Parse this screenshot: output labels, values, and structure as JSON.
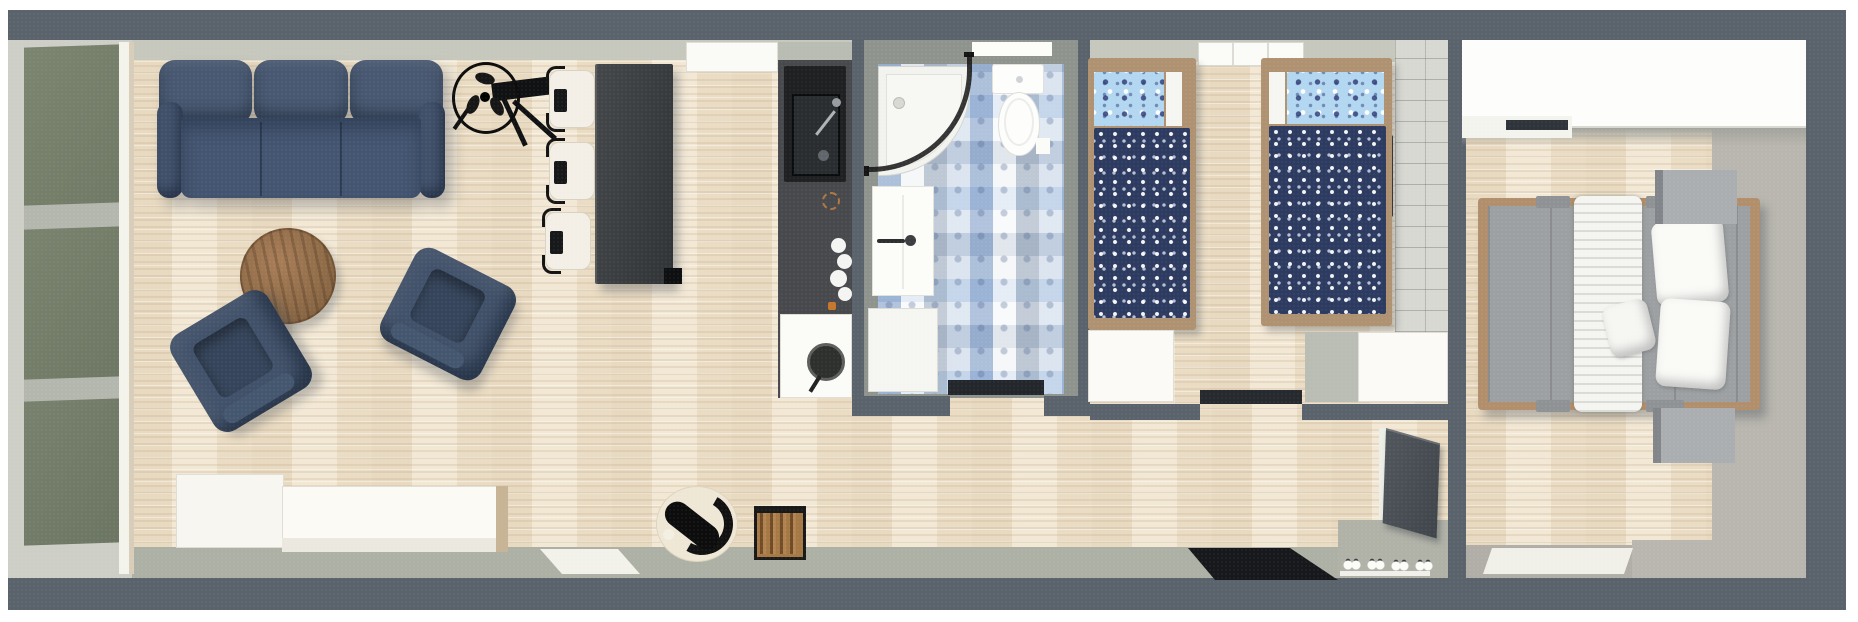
{
  "scene": {
    "kind": "3d floor plan, top-down view",
    "layout": "long narrow single-story home; living room and kitchen on left, bathroom and kids bedroom center, master bedroom right, hallway along bottom",
    "no_visible_text": true
  },
  "palette": {
    "outer_wall": "#5a626b",
    "inner_wall_top_face": "#c6c8be",
    "inner_wall_bottom_face": "#adb0a5",
    "wood_floor": "#efe2ca",
    "glass_door_green": "#77816d",
    "sofa_upholstery_blue": "#42526a",
    "coffee_table_wood": "#97714e",
    "counter_charcoal": "#47494c",
    "sink_black": "#1e2022",
    "bathroom_wall_gray": "#8f938e",
    "bathroom_tile_blue": "#a9c4e0",
    "kids_duvet_navy": "#2d3b60",
    "kids_pillow_blue": "#b3d7f0",
    "bed_frame_wood_tan": "#ae9272",
    "master_duvet_gray": "#9da0a2",
    "rug_gray": "#b8b6ae",
    "cabinet_white": "#f7f6f1",
    "doormat_black": "#17181b",
    "crate_wood": "#a57946"
  },
  "rooms": [
    {
      "name": "living-room",
      "position": "left",
      "floor": "light wood planks",
      "glazing": "full-height green glass doors on left end wall",
      "furniture": [
        "three-seat-sofa",
        "pedestal-fan",
        "black-side-table",
        "round-coffee-table",
        "armchair-left",
        "armchair-right",
        "white-sideboard",
        "bar-table",
        "bar-stool-1",
        "bar-stool-2",
        "bar-stool-3",
        "pet-bed",
        "firewood-crate",
        "white-floor-mat"
      ]
    },
    {
      "name": "kitchen",
      "position": "center-left along top wall",
      "furniture": [
        "white-upper-counter",
        "charcoal-counter",
        "black-sink-with-faucet",
        "gas-burner-ring",
        "hob-knobs",
        "oven-cabinet",
        "frying-pan"
      ]
    },
    {
      "name": "bathroom",
      "position": "center top",
      "floor": "blue-white patchwork tiles",
      "furniture": [
        "corner-shower-curved-glass",
        "toilet",
        "wall-shelf",
        "vanity-sink",
        "washer-cabinet",
        "dark-doormat"
      ]
    },
    {
      "name": "kids-bedroom",
      "position": "center-right",
      "floor": "light wood planks",
      "wall_finish": "gray tile wall on right side",
      "bedding": "navy polka-dot duvets with light-blue patterned pillows",
      "furniture": [
        "single-bed-left",
        "single-bed-right",
        "window-top-wall",
        "white-cabinet-left",
        "gray-dresser",
        "white-cabinet-right",
        "dark-doormat",
        "wall-handle"
      ]
    },
    {
      "name": "hallway",
      "position": "bottom strip",
      "furniture": [
        "entry-door-open",
        "black-doormat",
        "shoe-mat",
        "shoe-pairs"
      ]
    },
    {
      "name": "master-bedroom",
      "position": "right",
      "floor": "wood planks with gray rug on right side",
      "furniture": [
        "white-wardrobe-top-wall",
        "double-bed",
        "white-runner",
        "white-pillows",
        "nightstand-top",
        "nightstand-bottom",
        "white-door-threshold"
      ]
    }
  ],
  "counts": {
    "bar_stools": 3,
    "armchairs": 2,
    "single_beds": 2,
    "nightstands": 2,
    "shoe_pairs": 4,
    "green_glass_panels": 3
  }
}
